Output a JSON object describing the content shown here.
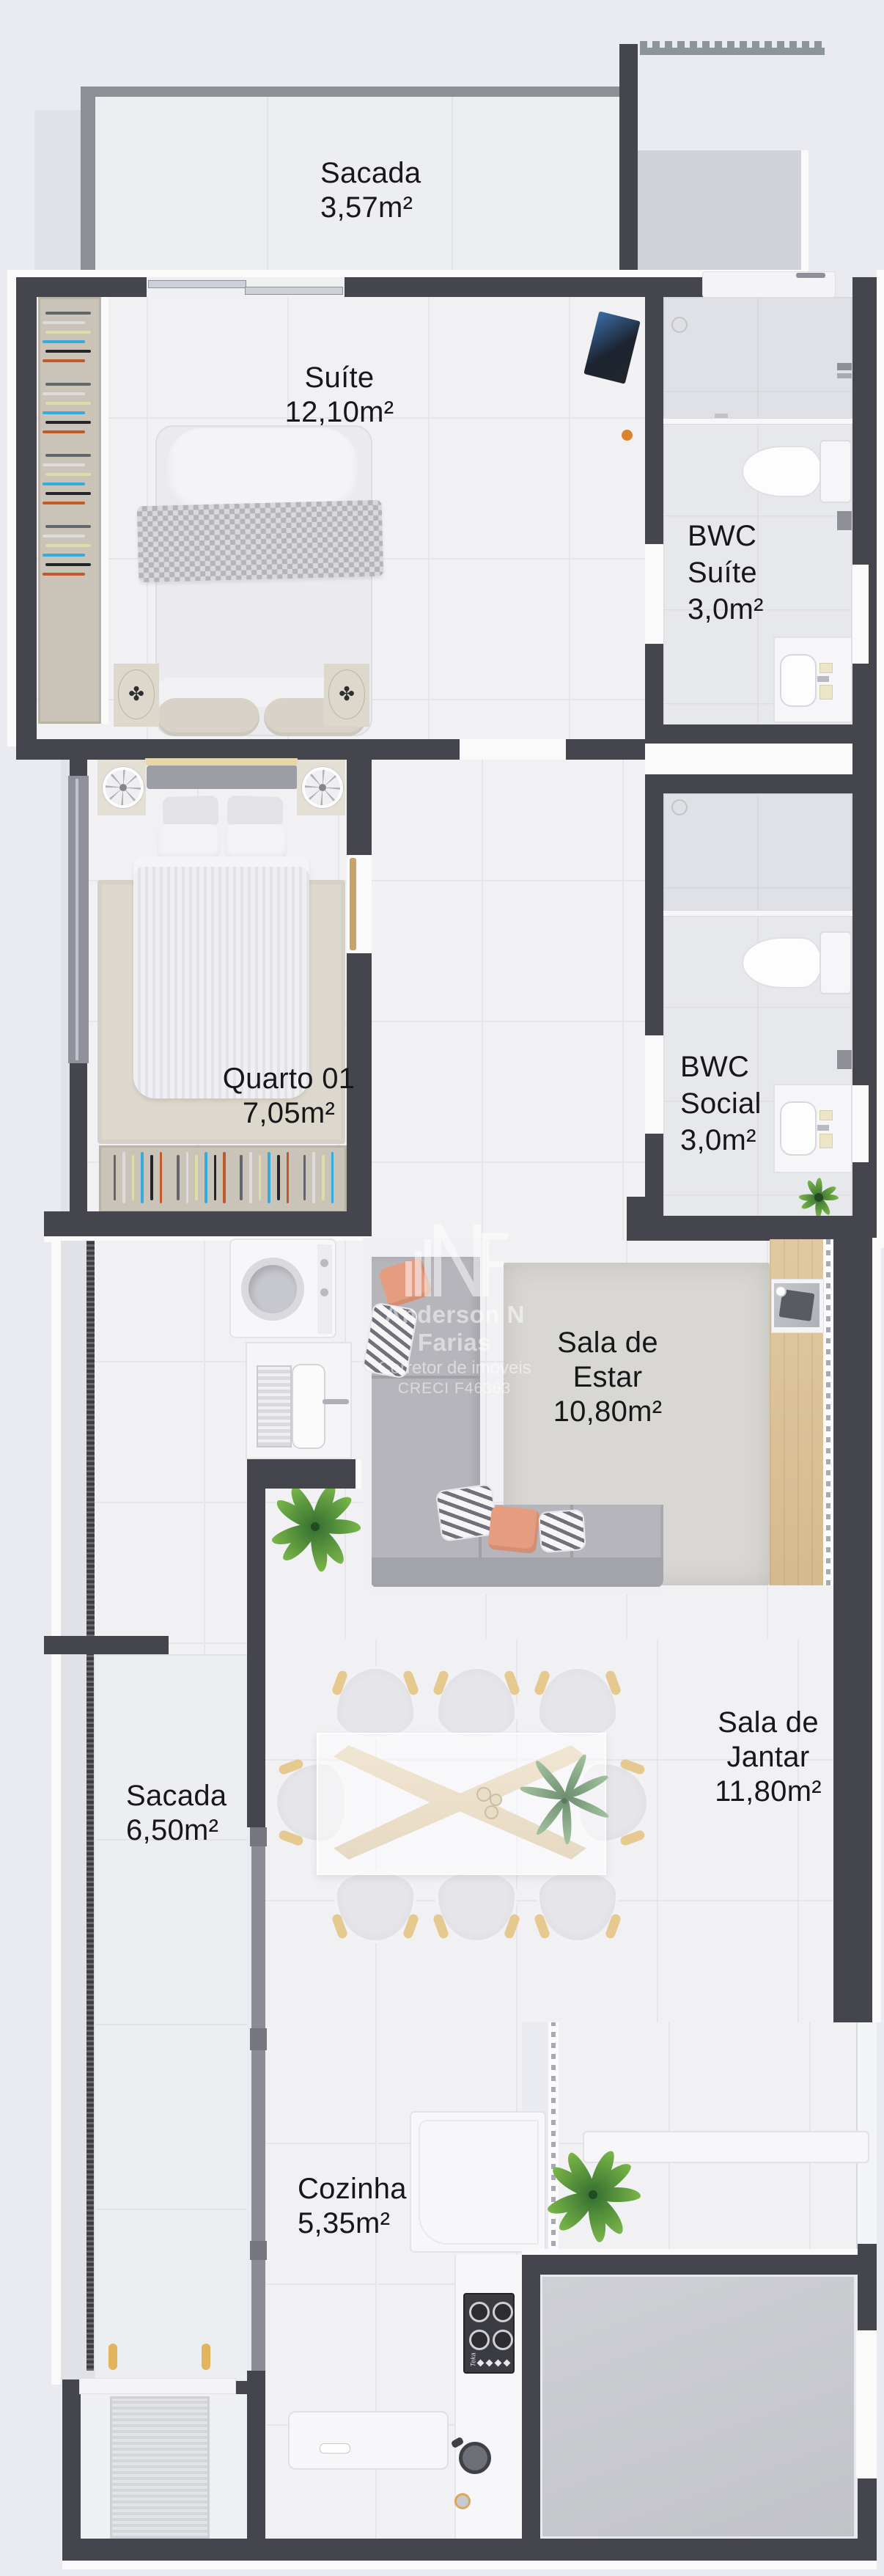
{
  "watermark": {
    "name": "Anderson N Farias",
    "role": "Corretor de imóveis",
    "creci": "CRECI F46363"
  },
  "rooms": {
    "sacada_top": {
      "name": "Sacada",
      "area": "3,57m²"
    },
    "suite": {
      "name": "Suíte",
      "area": "12,10m²"
    },
    "bwc_suite": {
      "l1": "BWC",
      "l2": "Suíte",
      "l3": "3,0m²"
    },
    "quarto01": {
      "name": "Quarto 01",
      "area": "7,05m²"
    },
    "bwc_social": {
      "l1": "BWC",
      "l2": "Social",
      "l3": "3,0m²"
    },
    "sala_estar": {
      "l1": "Sala de",
      "l2": "Estar",
      "l3": "10,80m²"
    },
    "sala_jantar": {
      "l1": "Sala de",
      "l2": "Jantar",
      "l3": "11,80m²"
    },
    "sacada_left": {
      "name": "Sacada",
      "area": "6,50m²"
    },
    "cozinha": {
      "name": "Cozinha",
      "area": "5,35m²"
    }
  },
  "appliances": {
    "cooktop_brand": "Teka"
  },
  "colors": {
    "wall": "#45454d",
    "floor": "#f1f1f4",
    "balcony_floor": "#edeef1",
    "bath_floor": "#e7e8ec",
    "rug": "#d9d7d3",
    "wood_deck": "#dcc49c",
    "closet": "#cac3b7",
    "sofa": "#b5b5bb",
    "plant_green": "#4e9b43",
    "pillow_salmon": "#e59c7f",
    "accent_orange": "#c05a28"
  },
  "closet_clothes_colors": [
    "#62666c",
    "#dcdcdf",
    "#d9dfa6",
    "#36abe0",
    "#232529",
    "#c05a28"
  ]
}
